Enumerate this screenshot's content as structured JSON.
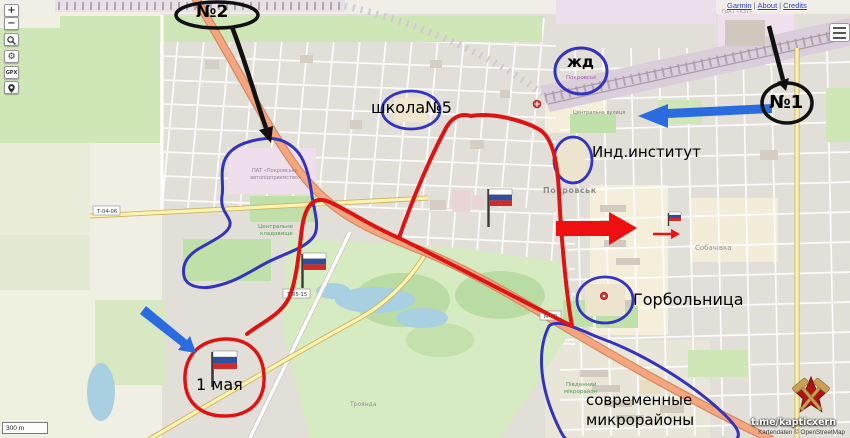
{
  "colors": {
    "annotation_red": "#dd1414",
    "annotation_blue": "#3333bb",
    "arrow_blue": "#2b6be0",
    "annotation_black": "#111111",
    "flag_white": "#ffffff",
    "flag_blue": "#2d4fa0",
    "flag_red": "#cf2b2b"
  },
  "controls": {
    "zoom_in": "+",
    "zoom_out": "−",
    "gpx": "GPX"
  },
  "header": {
    "links": [
      "Garmin",
      "About",
      "Credits"
    ],
    "separator": "|"
  },
  "scale": {
    "label": "300 m"
  },
  "watermark": {
    "channel": "t.me/kapticxern",
    "attribution": "Kartendaten © OpenStreetMap"
  },
  "annotations": {
    "route2": "№2",
    "route1": "№1",
    "school": "школа№5",
    "railway_station": "жд",
    "institute": "Инд.институт",
    "hospital": "Горбольница",
    "may_first": "1 мая",
    "modern_districts_line1": "современные",
    "modern_districts_line2": "микрорайоны"
  },
  "map_labels": {
    "city": "Покровськ",
    "station": "Покровськ",
    "district_sobachivka": "Собачівка",
    "village_troianda": "Троянда",
    "south_district_l1": "Південний",
    "south_district_l2": "мікрорайон",
    "cemetery_l1": "Центральне",
    "cemetery_l2": "кладовище",
    "industry_l1": "ПАТ «Покровське",
    "industry_l2": "автопідприємство»",
    "plant": "ГрАТ «КЗТ»",
    "street_central": "Центральна вулиця",
    "road_ref_t0406": "Т-04-06",
    "road_ref_t0515": "Т-05-15",
    "road_ref_m30": "М-30"
  }
}
